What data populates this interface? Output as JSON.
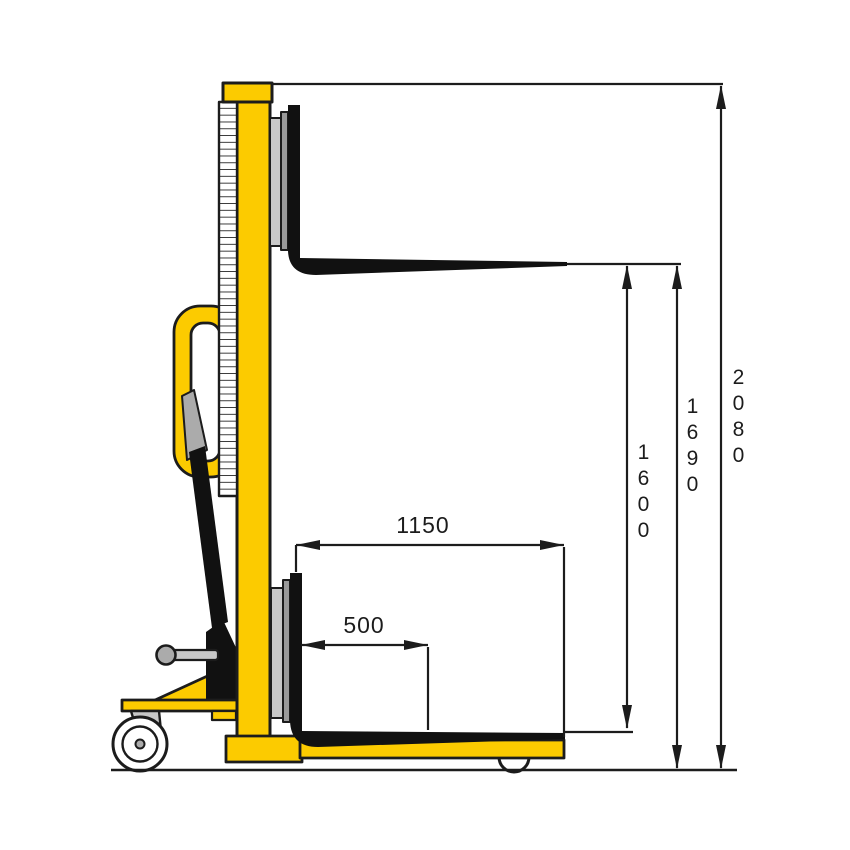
{
  "drawing": {
    "subject_label": "manual-stacker-side-view"
  },
  "dimensions": {
    "overall_height": {
      "label": "2080",
      "orientation": "vertical"
    },
    "fork_max_height": {
      "label": "1690",
      "orientation": "vertical"
    },
    "lift_height": {
      "label": "1600",
      "orientation": "vertical"
    },
    "fork_length": {
      "label": "1150",
      "orientation": "horizontal"
    },
    "load_center": {
      "label": "500",
      "orientation": "horizontal"
    }
  },
  "colors": {
    "yellow": "#FCCB00",
    "outline": "#1C1C1C",
    "black": "#111111",
    "grayLight": "#C8C8C8",
    "grayMid": "#ABABAB",
    "grayDark": "#9A9A9A",
    "white": "#FFFFFF"
  }
}
